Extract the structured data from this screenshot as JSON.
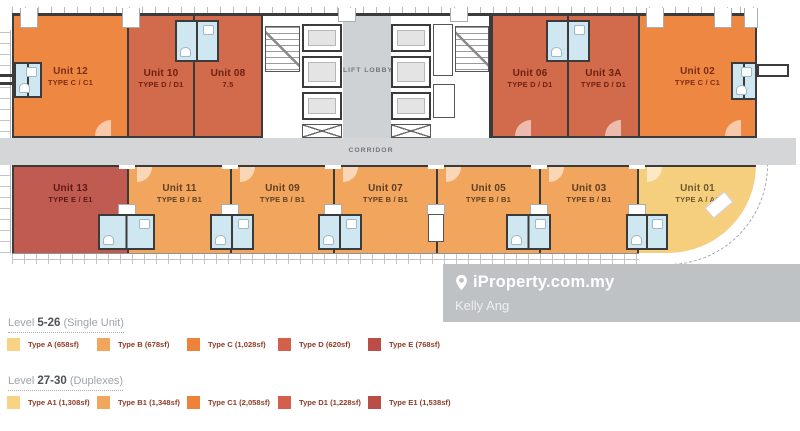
{
  "floor_plan": {
    "corridor_label": "CORRIDOR",
    "lift_lobby_label": "LIFT LOBBY",
    "top_units": [
      {
        "name": "Unit 12",
        "type": "TYPE C / C1",
        "color": "#EE8742",
        "text_color": "#7E2D17"
      },
      {
        "name": "Unit 10",
        "type": "TYPE D / D1",
        "color": "#D26A4C",
        "text_color": "#70200F"
      },
      {
        "name": "Unit 08",
        "type": "7.5",
        "color": "#D26A4C",
        "text_color": "#70200F"
      },
      {
        "name": "Unit 06",
        "type": "TYPE D / D1",
        "color": "#D26A4C",
        "text_color": "#70200F"
      },
      {
        "name": "Unit 3A",
        "type": "TYPE D / D1",
        "color": "#D26A4C",
        "text_color": "#70200F"
      },
      {
        "name": "Unit 02",
        "type": "TYPE C / C1",
        "color": "#EE8742",
        "text_color": "#7E2D17"
      }
    ],
    "bottom_units": [
      {
        "name": "Unit 13",
        "type": "TYPE E / E1",
        "color": "#BF5B51",
        "text_color": "#5E1A12"
      },
      {
        "name": "Unit 11",
        "type": "TYPE B / B1",
        "color": "#F2A55D",
        "text_color": "#5D4024"
      },
      {
        "name": "Unit 09",
        "type": "TYPE B / B1",
        "color": "#F2A55D",
        "text_color": "#5D4024"
      },
      {
        "name": "Unit 07",
        "type": "TYPE B / B1",
        "color": "#F2A55D",
        "text_color": "#5D4024"
      },
      {
        "name": "Unit 05",
        "type": "TYPE B / B1",
        "color": "#F2A55D",
        "text_color": "#5D4024"
      },
      {
        "name": "Unit 03",
        "type": "TYPE B / B1",
        "color": "#F2A55D",
        "text_color": "#5D4024"
      },
      {
        "name": "Unit 01",
        "type": "TYPE A / A1",
        "color": "#F6CF7E",
        "text_color": "#6E5A2F"
      }
    ]
  },
  "watermark": {
    "brand": "iProperty.com.my",
    "agent": "Kelly Ang"
  },
  "legend": {
    "sections": [
      {
        "prefix": "Level",
        "range": "5-26",
        "suffix": " (Single Unit)",
        "items": [
          {
            "label": "Type A (658sf)",
            "color": "#F7D383"
          },
          {
            "label": "Type B (678sf)",
            "color": "#F2A55D"
          },
          {
            "label": "Type C (1,028sf)",
            "color": "#ED8238"
          },
          {
            "label": "Type D (620sf)",
            "color": "#D2604A"
          },
          {
            "label": "Type E (768sf)",
            "color": "#BB4C46"
          }
        ]
      },
      {
        "prefix": "Level",
        "range": "27-30",
        "suffix": " (Duplexes)",
        "items": [
          {
            "label": "Type A1 (1,308sf)",
            "color": "#F7D383"
          },
          {
            "label": "Type B1 (1,348sf)",
            "color": "#F2A55D"
          },
          {
            "label": "Type C1 (2,058sf)",
            "color": "#ED8238"
          },
          {
            "label": "Type D1 (1,228sf)",
            "color": "#D2604A"
          },
          {
            "label": "Type E1 (1,538sf)",
            "color": "#BB4C46"
          }
        ]
      }
    ]
  }
}
